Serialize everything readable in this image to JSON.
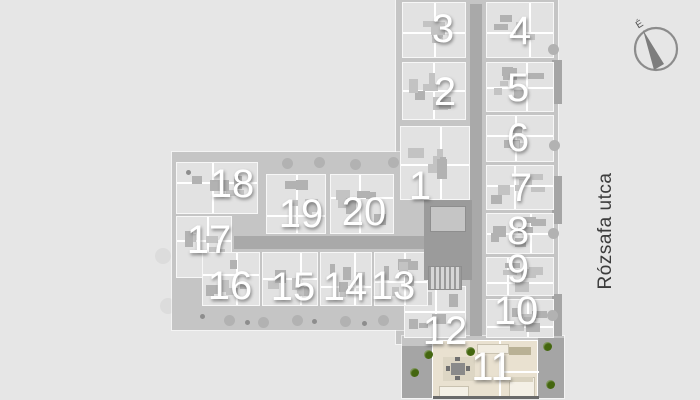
{
  "title": "apartment-building-floor-plan",
  "street": {
    "label": "Rózsafa utca"
  },
  "compass": {
    "north_label": "É"
  },
  "plan": {
    "highlighted_unit_label": "11",
    "units": [
      {
        "label": "1"
      },
      {
        "label": "2"
      },
      {
        "label": "3"
      },
      {
        "label": "4"
      },
      {
        "label": "5"
      },
      {
        "label": "6"
      },
      {
        "label": "7"
      },
      {
        "label": "8"
      },
      {
        "label": "9"
      },
      {
        "label": "10"
      },
      {
        "label": "11"
      },
      {
        "label": "12"
      },
      {
        "label": "13"
      },
      {
        "label": "14"
      },
      {
        "label": "15"
      },
      {
        "label": "16"
      },
      {
        "label": "17"
      },
      {
        "label": "18"
      },
      {
        "label": "19"
      },
      {
        "label": "20"
      }
    ]
  },
  "colors": {
    "background": "#e6e6e6",
    "building_mass": "#c5c5c5",
    "unit_floor": "#e2e2e2",
    "corridor": "#a9a9a9",
    "core": "#9b9b9b",
    "highlight_floor": "#e9e1d0",
    "terrace": "#a5a5a5",
    "plant_green": "#44660f",
    "unit_number": "#ffffff",
    "street_text": "#3c3c3c"
  }
}
